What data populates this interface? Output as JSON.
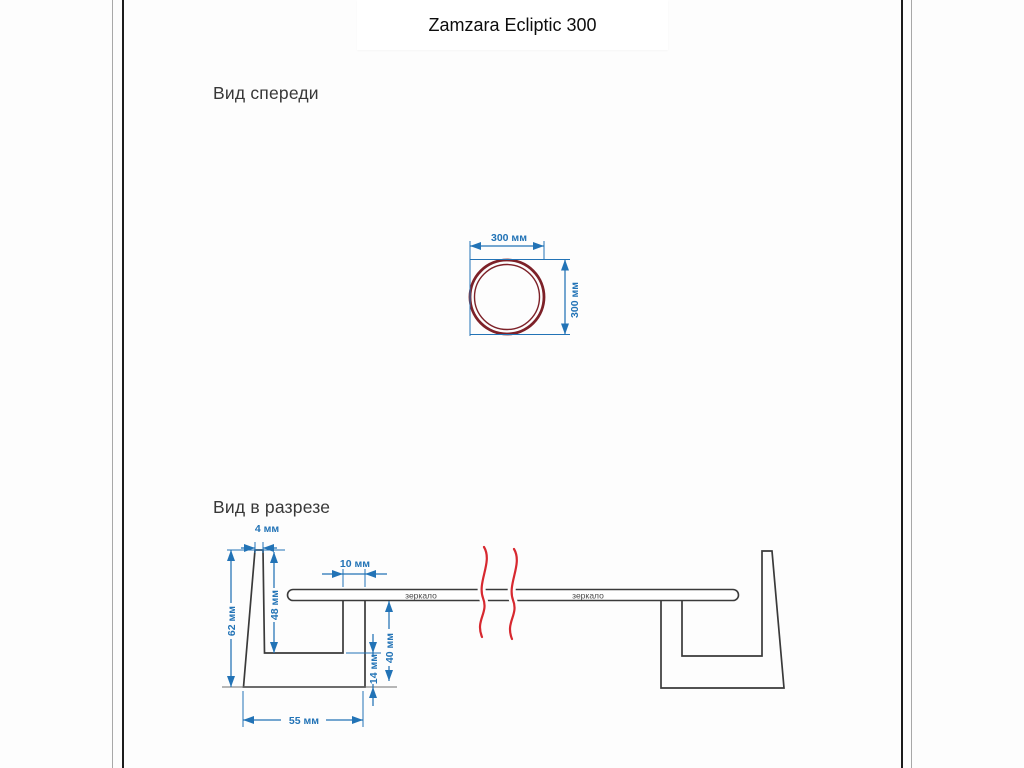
{
  "title": "Zamzara Ecliptic 300",
  "front_view": {
    "label": "Вид спереди",
    "diameter_h": "300 мм",
    "diameter_v": "300 мм"
  },
  "section_view": {
    "label": "Вид в разрезе",
    "frame_top_thickness": "4 мм",
    "frame_height": "62 мм",
    "frame_inner_depth": "48 мм",
    "frame_wall_thickness": "10 мм",
    "mirror_to_base": "40 мм",
    "base_thickness": "14 мм",
    "base_width": "55 мм",
    "mirror_label_left": "зеркало",
    "mirror_label_right": "зеркало"
  },
  "colors": {
    "page_bg": "#fdfdfd",
    "dimension_blue": "#2273b6",
    "outline_dark": "#3a3a3a",
    "mirror_ring": "#7d2128",
    "break_red": "#d7282f"
  }
}
